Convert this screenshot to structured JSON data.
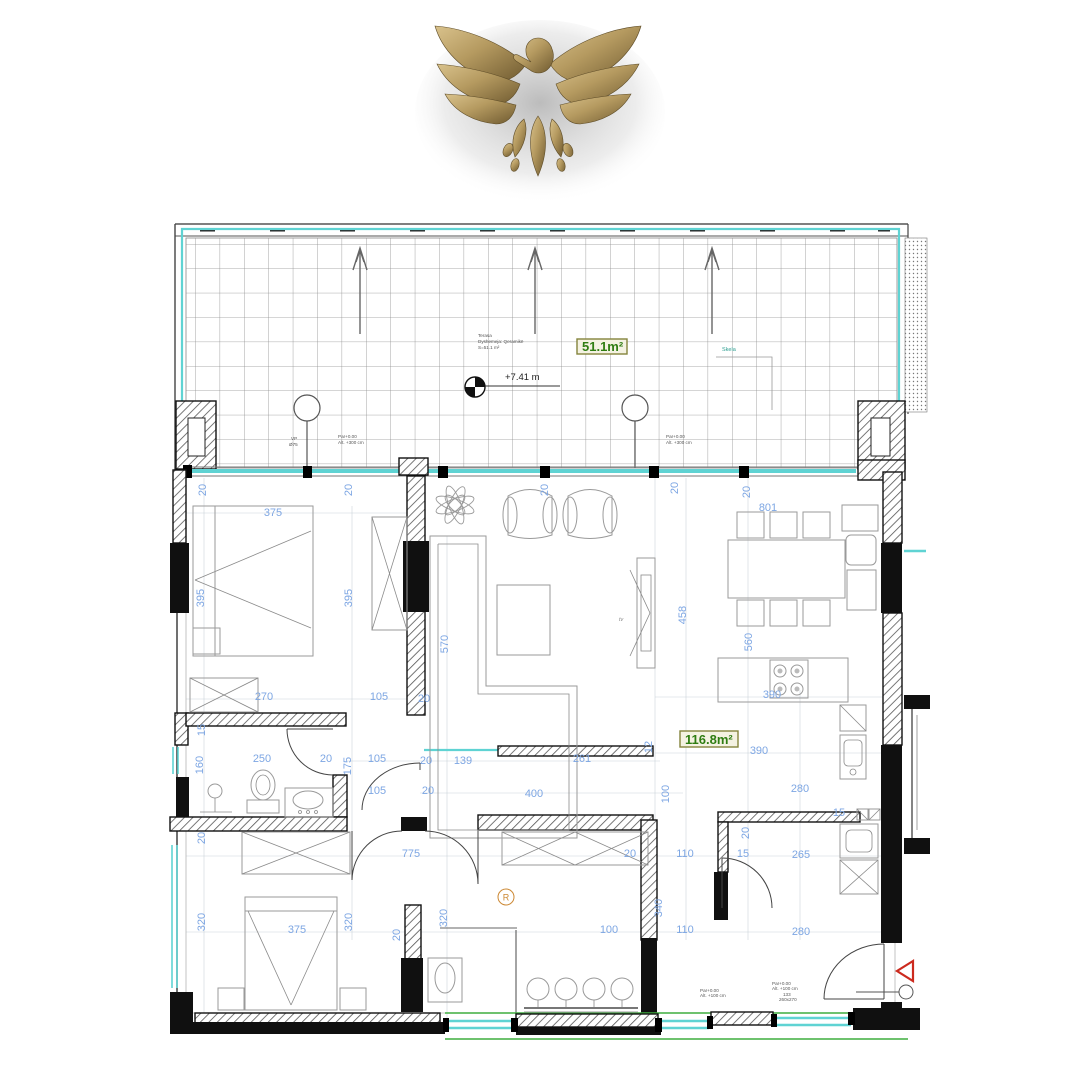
{
  "logo": {
    "name": "gold-eagle-logo"
  },
  "terrace": {
    "area_label": "51.1m²",
    "note_lines": [
      "Terasa",
      "Dyshemeja: Qeramikë",
      "S=51.1 m²"
    ],
    "level_label": "+7.41 m",
    "skela_label": "Skela"
  },
  "apartment": {
    "area_label": "116.8m²",
    "radiator_label": "R",
    "tv_label": "tv"
  },
  "notes": [
    {
      "t": "Par+0.00",
      "x": 338,
      "y": 438
    },
    {
      "t": "Alt. +300 cm",
      "x": 338,
      "y": 444
    },
    {
      "t": "VP",
      "x": 291,
      "y": 440
    },
    {
      "t": "Ø75",
      "x": 289,
      "y": 446
    },
    {
      "t": "Par+0.00",
      "x": 666,
      "y": 438
    },
    {
      "t": "Alt. +300 cm",
      "x": 666,
      "y": 444
    },
    {
      "t": "Par+0.00",
      "x": 700,
      "y": 992
    },
    {
      "t": "Alt. +100 cm",
      "x": 700,
      "y": 997
    },
    {
      "t": "Par+0.00",
      "x": 772,
      "y": 985
    },
    {
      "t": "Alt. +100 cm",
      "x": 772,
      "y": 990
    },
    {
      "t": "133",
      "x": 783,
      "y": 996
    },
    {
      "t": "260x270",
      "x": 779,
      "y": 1001
    }
  ],
  "dimensions": [
    {
      "t": "20",
      "x": 206,
      "y": 490,
      "r": -90
    },
    {
      "t": "375",
      "x": 273,
      "y": 516
    },
    {
      "t": "20",
      "x": 352,
      "y": 490,
      "r": -90
    },
    {
      "t": "20",
      "x": 548,
      "y": 490,
      "r": -90
    },
    {
      "t": "20",
      "x": 678,
      "y": 488,
      "r": -90
    },
    {
      "t": "801",
      "x": 768,
      "y": 511
    },
    {
      "t": "20",
      "x": 750,
      "y": 492,
      "r": -90
    },
    {
      "t": "395",
      "x": 204,
      "y": 598,
      "r": -90
    },
    {
      "t": "395",
      "x": 352,
      "y": 598,
      "r": -90
    },
    {
      "t": "570",
      "x": 448,
      "y": 644,
      "r": -90
    },
    {
      "t": "458",
      "x": 686,
      "y": 615,
      "r": -90
    },
    {
      "t": "560",
      "x": 752,
      "y": 642,
      "r": -90
    },
    {
      "t": "270",
      "x": 264,
      "y": 700
    },
    {
      "t": "105",
      "x": 379,
      "y": 700
    },
    {
      "t": "20",
      "x": 424,
      "y": 702
    },
    {
      "t": "390",
      "x": 772,
      "y": 698
    },
    {
      "t": "15",
      "x": 205,
      "y": 730,
      "r": -90
    },
    {
      "t": "250",
      "x": 262,
      "y": 762
    },
    {
      "t": "20",
      "x": 326,
      "y": 762
    },
    {
      "t": "175",
      "x": 351,
      "y": 766,
      "r": -90
    },
    {
      "t": "105",
      "x": 377,
      "y": 762
    },
    {
      "t": "20",
      "x": 426,
      "y": 764
    },
    {
      "t": "139",
      "x": 463,
      "y": 764
    },
    {
      "t": "261",
      "x": 582,
      "y": 762
    },
    {
      "t": "12",
      "x": 652,
      "y": 747,
      "r": -90
    },
    {
      "t": "160",
      "x": 203,
      "y": 765,
      "r": -90
    },
    {
      "t": "105",
      "x": 377,
      "y": 794
    },
    {
      "t": "20",
      "x": 428,
      "y": 794
    },
    {
      "t": "400",
      "x": 534,
      "y": 797
    },
    {
      "t": "100",
      "x": 669,
      "y": 794,
      "r": -90
    },
    {
      "t": "390",
      "x": 759,
      "y": 754
    },
    {
      "t": "280",
      "x": 800,
      "y": 792
    },
    {
      "t": "20",
      "x": 205,
      "y": 838,
      "r": -90
    },
    {
      "t": "775",
      "x": 411,
      "y": 857
    },
    {
      "t": "20",
      "x": 630,
      "y": 857
    },
    {
      "t": "110",
      "x": 685,
      "y": 857
    },
    {
      "t": "15",
      "x": 743,
      "y": 857
    },
    {
      "t": "265",
      "x": 801,
      "y": 858
    },
    {
      "t": "20",
      "x": 749,
      "y": 833,
      "r": -90
    },
    {
      "t": "15",
      "x": 839,
      "y": 816
    },
    {
      "t": "320",
      "x": 205,
      "y": 922,
      "r": -90
    },
    {
      "t": "375",
      "x": 297,
      "y": 933
    },
    {
      "t": "320",
      "x": 352,
      "y": 922,
      "r": -90
    },
    {
      "t": "20",
      "x": 400,
      "y": 935,
      "r": -90
    },
    {
      "t": "320",
      "x": 447,
      "y": 918,
      "r": -90
    },
    {
      "t": "340",
      "x": 662,
      "y": 908,
      "r": -90
    },
    {
      "t": "100",
      "x": 609,
      "y": 933
    },
    {
      "t": "110",
      "x": 685,
      "y": 933
    },
    {
      "t": "280",
      "x": 801,
      "y": 935
    }
  ],
  "colors": {
    "dimension_blue": "#7da6e3",
    "area_green": "#2f7d12",
    "window_cyan": "#5fd3d3",
    "exterior_green": "#3fae3f",
    "entrance_red": "#cc2a1e",
    "radiator_orange": "#cc8833",
    "gold": "#b59a60"
  }
}
